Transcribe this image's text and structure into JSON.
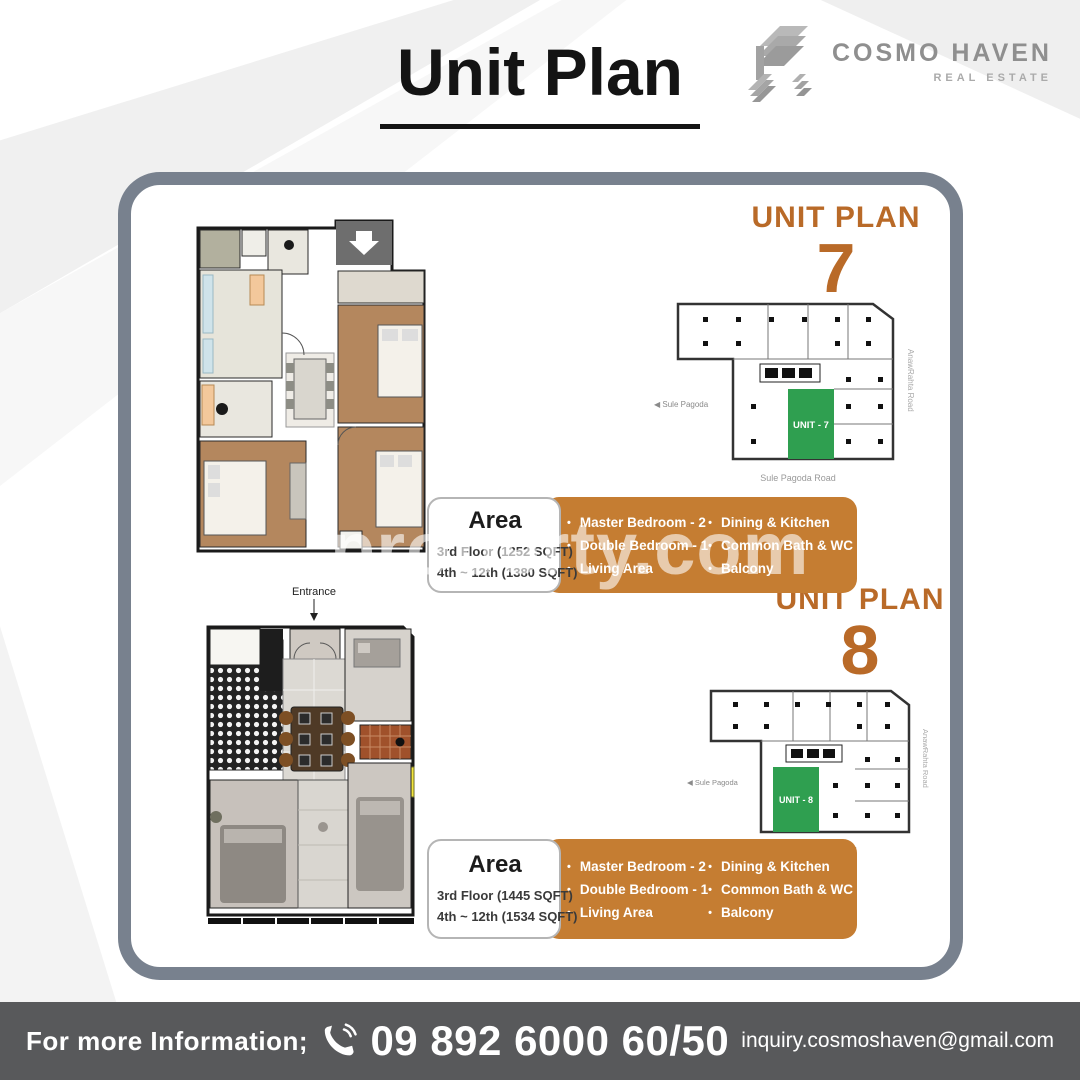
{
  "header": {
    "title": "Unit Plan"
  },
  "brand": {
    "name": "COSMO HAVEN",
    "tagline": "REAL ESTATE"
  },
  "watermark": "property.com",
  "units": [
    {
      "heading": "UNIT PLAN",
      "number": "7",
      "site": {
        "unit_label": "UNIT - 7",
        "left_label": "◀ Sule Pagoda",
        "bottom_label": "Sule Pagoda Road",
        "right_label": "AnawRahta Road"
      },
      "area": {
        "title": "Area",
        "floor_lines": [
          "3rd Floor (1252 SQFT)",
          "4th ~ 12th (1380 SQFT)"
        ],
        "features_col1": [
          "Master Bedroom - 2",
          "Double Bedroom - 1",
          "Living Area"
        ],
        "features_col2": [
          "Dining & Kitchen",
          "Common Bath & WC",
          "Balcony"
        ]
      }
    },
    {
      "heading": "UNIT PLAN",
      "number": "8",
      "entrance_label": "Entrance",
      "site": {
        "unit_label": "UNIT - 8",
        "left_label": "◀ Sule Pagoda",
        "bottom_label": "Sule Pagoda Road",
        "right_label": "AnawRahta Road"
      },
      "area": {
        "title": "Area",
        "floor_lines": [
          "3rd Floor (1445 SQFT)",
          "4th ~ 12th (1534 SQFT)"
        ],
        "features_col1": [
          "Master Bedroom - 2",
          "Double Bedroom - 1",
          "Living Area"
        ],
        "features_col2": [
          "Dining & Kitchen",
          "Common Bath & WC",
          "Balcony"
        ]
      }
    }
  ],
  "footer": {
    "info_label": "For more Information;",
    "phone": "09 892 6000 60/50",
    "email": "inquiry.cosmoshaven@gmail.com"
  },
  "colors": {
    "accent_orange": "#c57d32",
    "unit_green": "#2f9f50",
    "frame_gray": "#78818e",
    "footer_gray": "#58595b"
  }
}
